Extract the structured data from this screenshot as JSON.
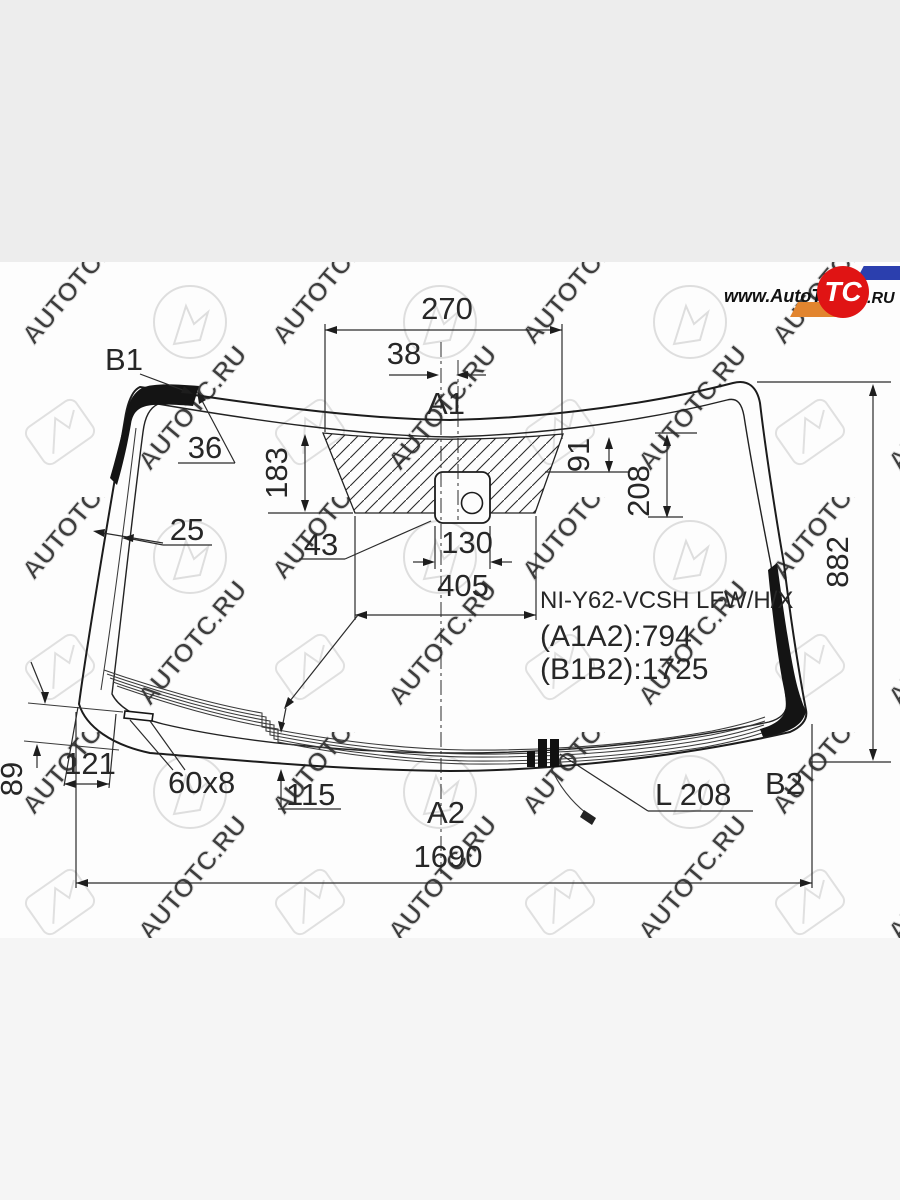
{
  "logo": {
    "left": "www.AutoT",
    "circle": "TC",
    "right": ".RU"
  },
  "watermark": {
    "text": "AUTOTC.RU"
  },
  "part": {
    "code": "NI-Y62-VCSH LFW/H/X",
    "a1a2": "(A1A2):794",
    "b1b2": "(B1B2):1725"
  },
  "labels": {
    "a1": "A1",
    "a2": "A2",
    "b1": "B1",
    "b2": "B2"
  },
  "dims": {
    "d270": "270",
    "d38": "38",
    "d36": "36",
    "d25": "25",
    "d183": "183",
    "d91": "91",
    "d208": "208",
    "d882": "882",
    "d43": "43",
    "d130": "130",
    "d405": "405",
    "d89": "89",
    "d121": "121",
    "d60x8": "60x8",
    "d115": "115",
    "dL208": "L 208",
    "d1690": "1690"
  }
}
